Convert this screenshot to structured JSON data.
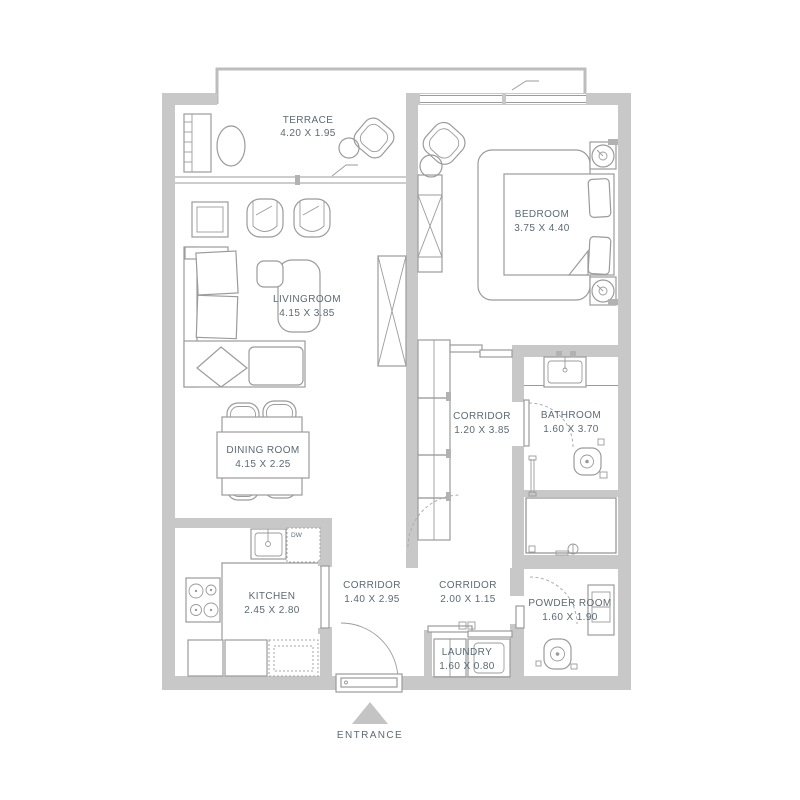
{
  "plan": {
    "rooms": {
      "terrace": {
        "name": "TERRACE",
        "dims": "4.20 X 1.95"
      },
      "bedroom": {
        "name": "BEDROOM",
        "dims": "3.75 X 4.40"
      },
      "livingroom": {
        "name": "LIVINGROOM",
        "dims": "4.15 X 3.85"
      },
      "dining_room": {
        "name": "DINING ROOM",
        "dims": "4.15 X 2.25"
      },
      "kitchen": {
        "name": "KITCHEN",
        "dims": "2.45 X 2.80"
      },
      "corridor_bedroom": {
        "name": "CORRIDOR",
        "dims": "1.20 X 3.85"
      },
      "corridor_entry": {
        "name": "CORRIDOR",
        "dims": "1.40 X 2.95"
      },
      "corridor_inner": {
        "name": "CORRIDOR",
        "dims": "2.00 X 1.15"
      },
      "bathroom": {
        "name": "BATHROOM",
        "dims": "1.60 X 3.70"
      },
      "powder_room": {
        "name": "POWDER ROOM",
        "dims": "1.60 X 1.90"
      },
      "laundry": {
        "name": "LAUNDRY",
        "dims": "1.60 X 0.80"
      }
    },
    "labels": {
      "entrance": "ENTRANCE",
      "dishwasher": "DW"
    },
    "colors": {
      "wall": "#c8c8c8",
      "furniture_line": "#9b9b9b",
      "label_text": "#5b6a76",
      "background": "#ffffff",
      "entrance_arrow": "#c4c4c4"
    }
  }
}
